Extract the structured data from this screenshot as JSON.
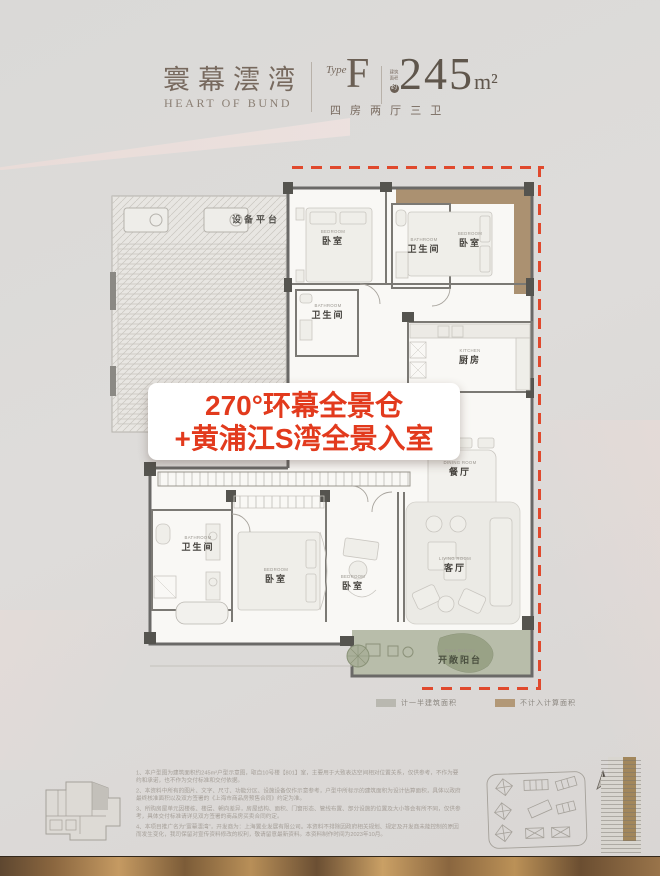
{
  "header": {
    "brand_cn": "寰幕澐湾",
    "brand_en": "HEART OF BUND",
    "type_label": "Type",
    "type_value": "F",
    "area_note_line1": "建筑",
    "area_note_line2": "面积",
    "area_note_circle": "约",
    "area_value": "245",
    "area_unit": "m²",
    "layout_desc": "四 房 两 厅 三 卫"
  },
  "banner": {
    "line1": "270°环幕全景仓",
    "line2": "+黄浦江S湾全景入室",
    "accent_color": "#e23a1d"
  },
  "plan": {
    "platform_label": "设备平台",
    "rooms": [
      {
        "en": "BEDROOM",
        "cn": "卧室"
      },
      {
        "en": "BATHROOM",
        "cn": "卫生间"
      },
      {
        "en": "BEDROOM",
        "cn": "卧室"
      },
      {
        "en": "BATHROOM",
        "cn": "卫生间"
      },
      {
        "en": "KITCHEN",
        "cn": "厨房"
      },
      {
        "en": "DINING ROOM",
        "cn": "餐厅"
      },
      {
        "en": "BATHROOM",
        "cn": "卫生间"
      },
      {
        "en": "BEDROOM",
        "cn": "卧室"
      },
      {
        "en": "BEDROOM",
        "cn": "卧室"
      },
      {
        "en": "LIVING ROOM",
        "cn": "客厅"
      },
      {
        "en": "Open Balcony",
        "cn": "开敞阳台"
      }
    ],
    "dash_color": "#e0492d"
  },
  "legend": {
    "items": [
      {
        "label": "计一半建筑面积",
        "color": "#b9b8b0"
      },
      {
        "label": "不计入计算面积",
        "color": "#b29877"
      }
    ]
  },
  "footer": {
    "disclaimer": [
      "1、本户型图为建筑面积约245m²户型示意图，取自10号楼【801】室，主要用于大致表达空间相对位置关系，仅供参考，不作为要约和承诺，也不作为交付标准和交付依据。",
      "2、本资料中所有的图片、文字、尺寸、功能分区、设施设备仅作示意参考，户型中所标示的建筑面积为设计估算面积，具体以政府最终核准面积以及双方签署的《上海市商品房预售合同》约定为准。",
      "3、所购房屋单元因楼栋、楼层、朝向差异，房屋结构、面积、门窗形态、管线布置、部分设施的位置及大小等会有所不同，仅供参考，具体交付标准请详见双方签署的商品房买卖合同约定。",
      "4、本项目推广名为“寰幕澐湾”，开发商为：上海置业发展有限公司。本资料不排除因政府相关规划、规定及开发商未能控制的原因而发生变化，我司保留对宣传资料修改的权利，敬请留意最新资料。本资料制作时间为2023年10月。"
    ]
  }
}
